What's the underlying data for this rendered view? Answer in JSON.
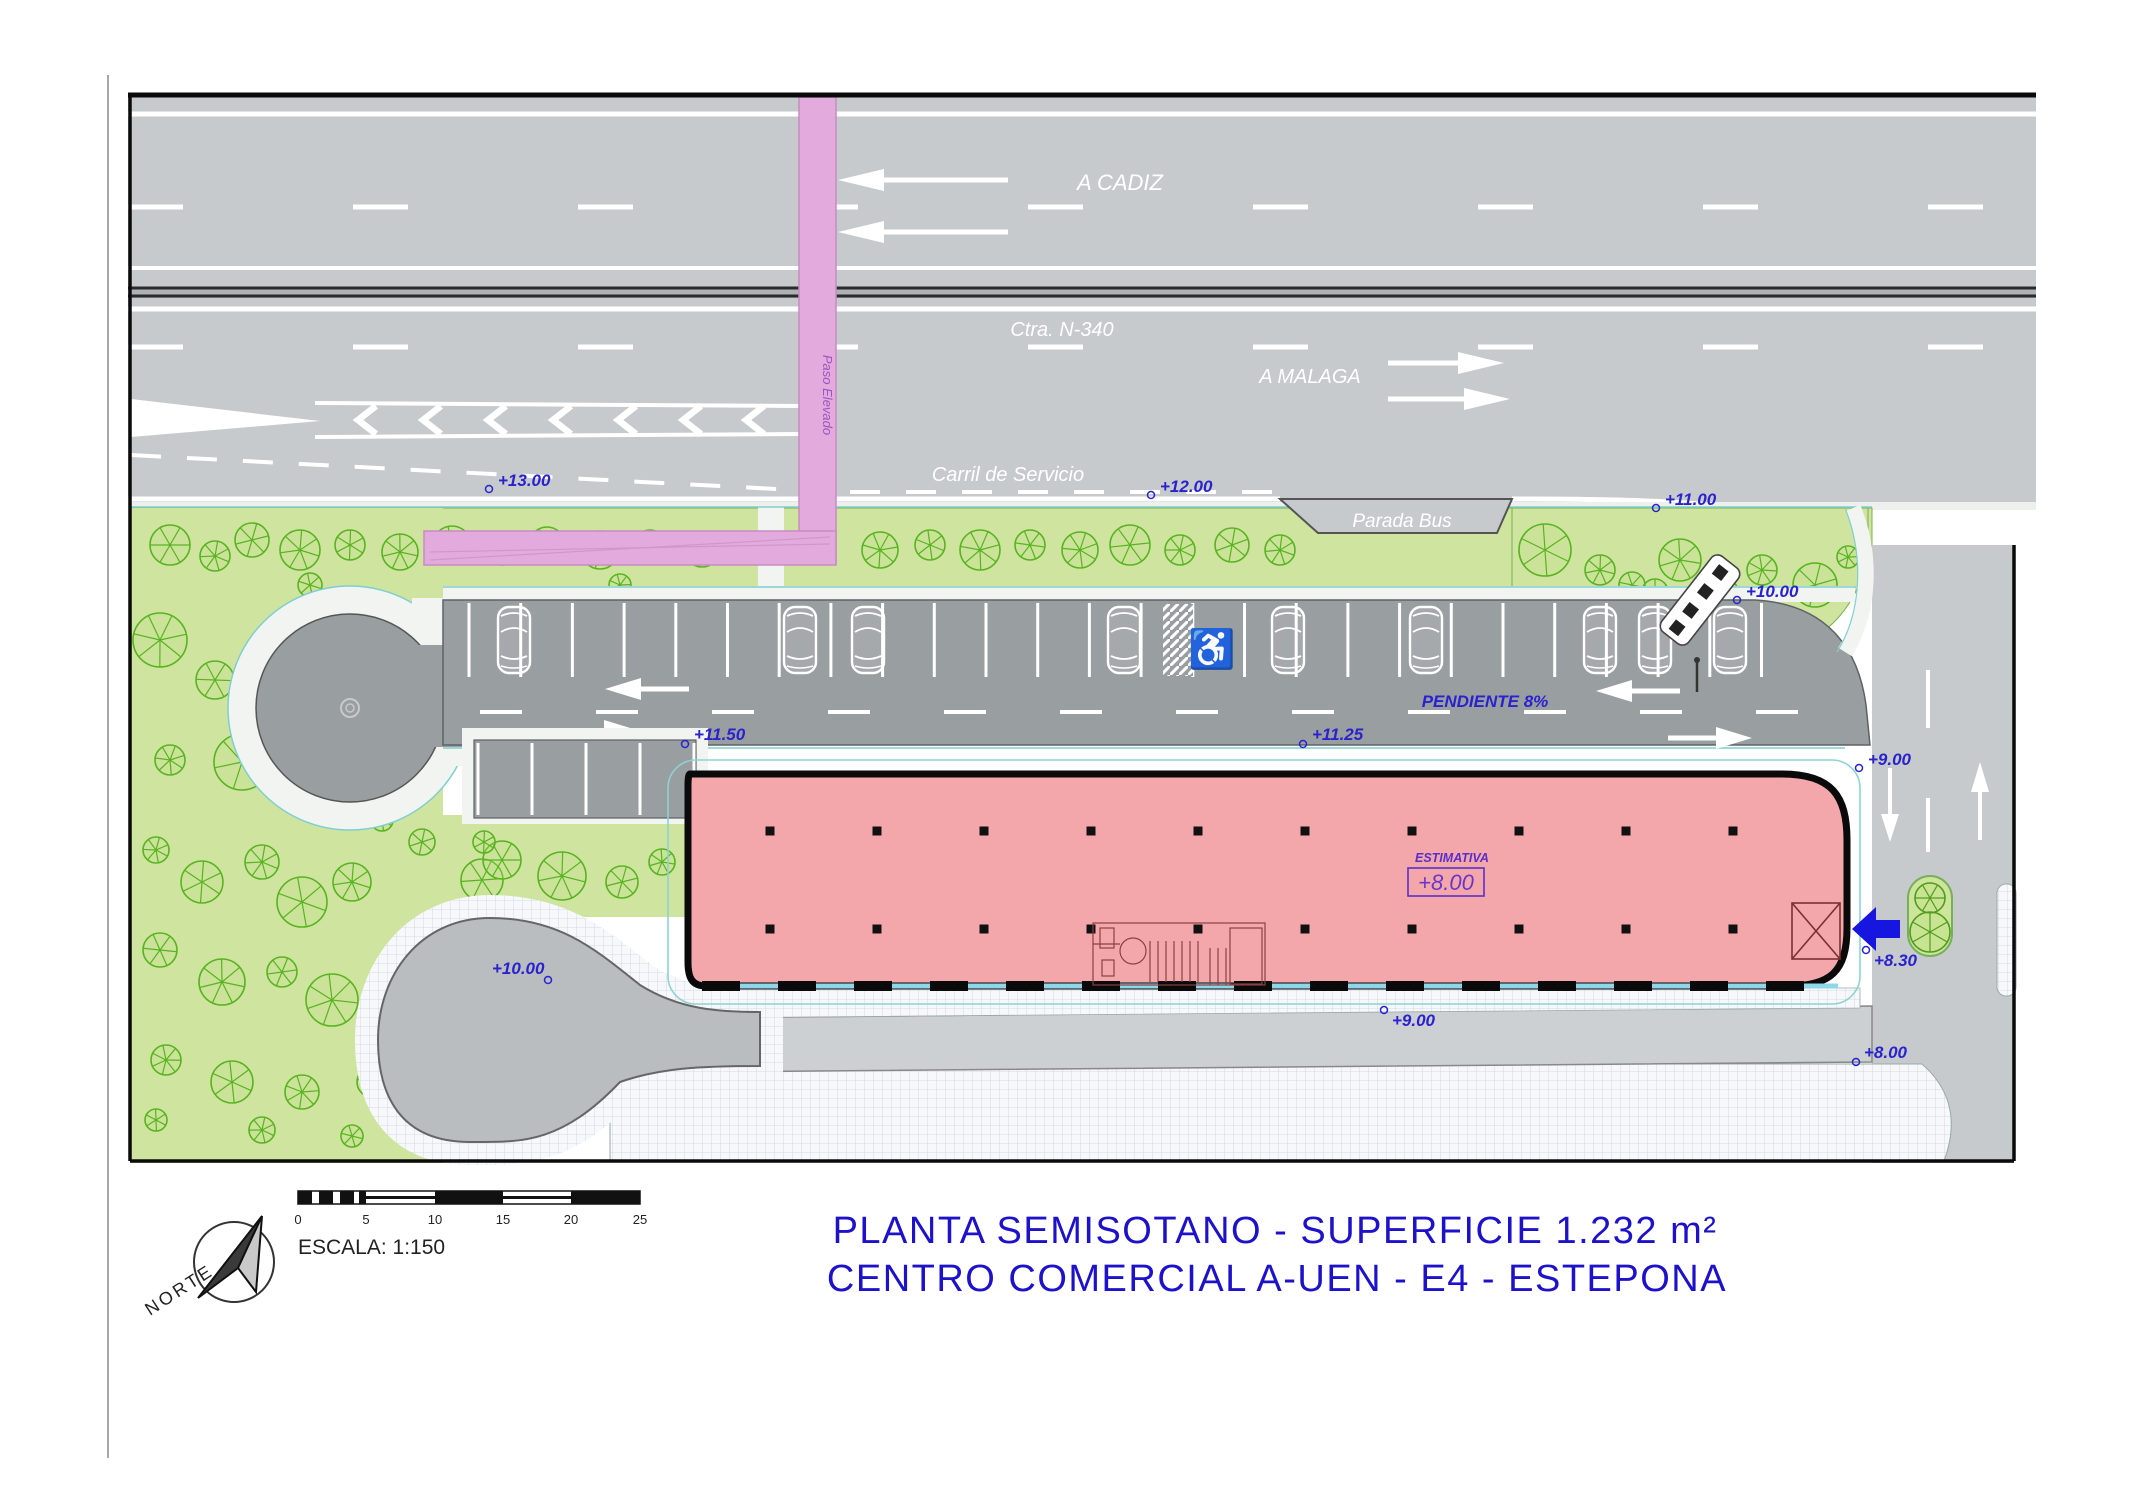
{
  "plan": {
    "road_labels": {
      "a_cadiz": "A CADIZ",
      "ctra": "Ctra. N-340",
      "a_malaga": "A MALAGA",
      "carril": "Carril de Servicio",
      "parada_bus": "Parada Bus",
      "paso_elevado": "Paso Elevado",
      "pendiente": "PENDIENTE 8%"
    },
    "elevations": {
      "e13": "+13.00",
      "e12": "+12.00",
      "e11": "+11.00",
      "e10_right": "+10.00",
      "e11_50": "+11.50",
      "e11_25": "+11.25",
      "e9_right": "+9.00",
      "e8_30": "+8.30",
      "e8_right": "+8.00",
      "e9_bottom": "+9.00",
      "e10_path": "+10.00"
    },
    "building": {
      "estimativa_label": "ESTIMATIVA",
      "estimativa_value": "+8.00"
    }
  },
  "legend": {
    "scale_label": "ESCALA: 1:150",
    "scale_ticks": [
      "0",
      "5",
      "10",
      "15",
      "20",
      "25"
    ],
    "north_label": "NORTE"
  },
  "title": {
    "line1": "PLANTA SEMISOTANO - SUPERFICIE 1.232 m²",
    "line2": "CENTRO COMERCIAL A-UEN - E4 - ESTEPONA"
  },
  "colors": {
    "road_gray": "#c6cacc",
    "parking_gray": "#999ea1",
    "grass_green": "#cfe49f",
    "tree_green": "#58b321",
    "building_pink": "#f4a7aa",
    "path_pink": "#e3abdd",
    "label_blue": "#2a22cc",
    "title_blue": "#1d12c9",
    "arrow_blue": "#1616e0",
    "curb_teal": "#7fcfcf"
  }
}
